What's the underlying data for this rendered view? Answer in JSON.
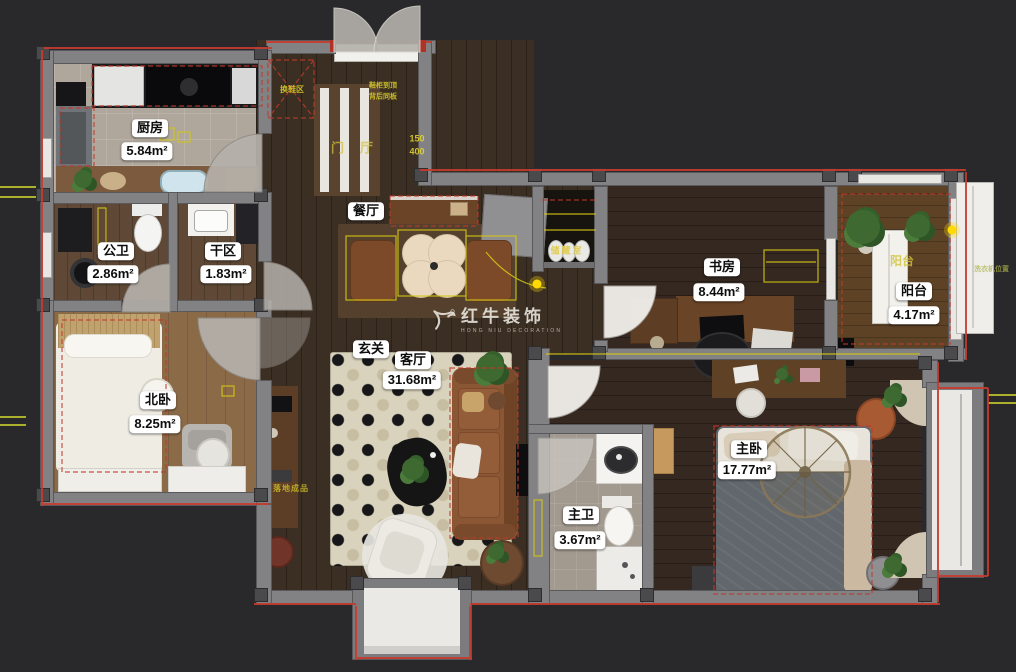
{
  "watermark": {
    "brand": "红牛装饰",
    "subtitle": "HONG NIU DECORATION"
  },
  "rooms": {
    "kitchen": {
      "name": "厨房",
      "area": "5.84m²"
    },
    "public_bath": {
      "name": "公卫",
      "area": "2.86m²"
    },
    "dry_area": {
      "name": "干区",
      "area": "1.83m²"
    },
    "dining": {
      "name": "餐厅"
    },
    "foyer": {
      "name": "门厅"
    },
    "entry": {
      "name": "玄关"
    },
    "living": {
      "name": "客厅",
      "area": "31.68m²"
    },
    "north_bedroom": {
      "name": "北卧",
      "area": "8.25m²"
    },
    "study": {
      "name": "书房",
      "area": "8.44m²"
    },
    "balcony": {
      "name": "阳台",
      "area": "4.17m²"
    },
    "master_bedroom": {
      "name": "主卧",
      "area": "17.77m²"
    },
    "master_bath": {
      "name": "主卫",
      "area": "3.67m²"
    },
    "storage": {
      "name": "储藏室"
    }
  },
  "annotations": {
    "balcony_floor_tag": "阳台",
    "cabinet_note_line1": "鞋柜到顶",
    "cabinet_note_line2": "背后同板",
    "dim_a": "150",
    "dim_b": "400",
    "entry_zone": "换鞋区",
    "curtain_note": "落地成品",
    "washer_note": "洗衣机位置"
  },
  "colors": {
    "background": "#29292b",
    "wall": "#828284",
    "exterior_line": "#c63a2e",
    "cad_yellow": "#d6c937",
    "label_bg": "#ffffff"
  }
}
